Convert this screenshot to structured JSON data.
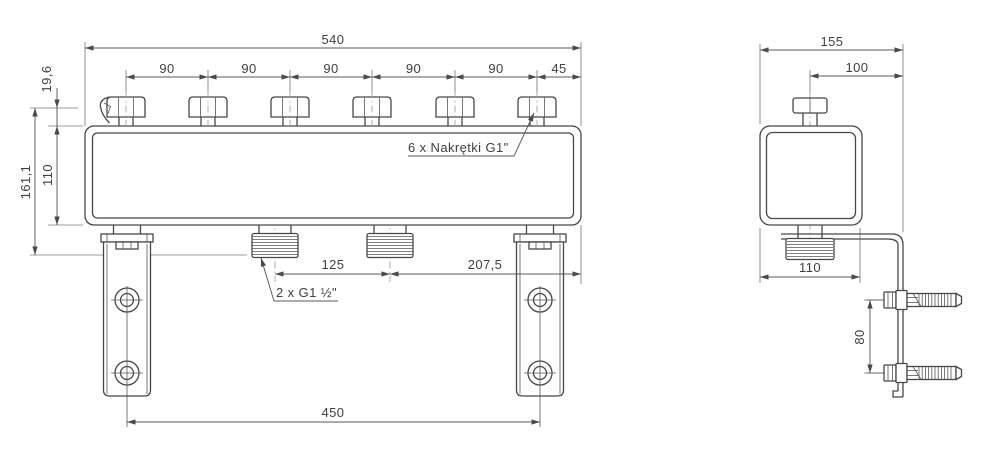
{
  "front_view": {
    "dim_total_width": "540",
    "dim_pitches": [
      "90",
      "90",
      "90",
      "90",
      "90",
      "45"
    ],
    "dim_vent_height": "19,6",
    "dim_body_height": "110",
    "dim_total_height": "161,1",
    "dim_port_spacing": "125",
    "dim_port_to_edge": "207,5",
    "dim_bracket_span": "450",
    "label_nuts": "6 x Nakrętki G1\"",
    "label_ports": "2 x G1 ½\""
  },
  "side_view": {
    "dim_depth": "155",
    "dim_nut_to_bracket": "100",
    "dim_body_depth": "110",
    "dim_anchor_spacing": "80"
  },
  "colors": {
    "line": "#474747",
    "dimension": "#5a5a5a",
    "background": "#ffffff"
  }
}
